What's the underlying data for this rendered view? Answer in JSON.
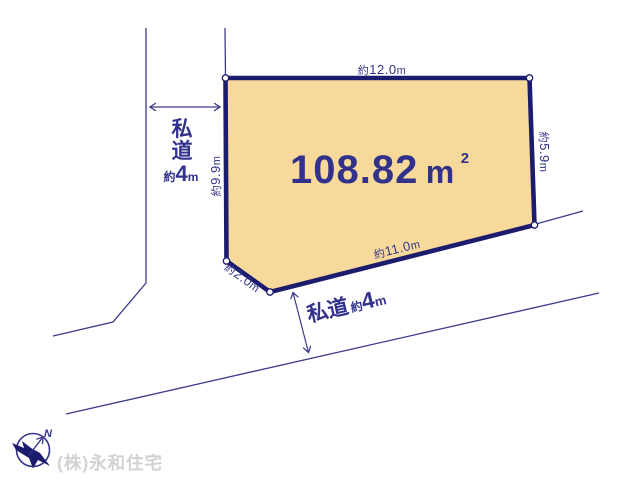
{
  "colors": {
    "plot_fill": "#f8d99c",
    "plot_border": "#1c1c6e",
    "text_navy": "#32328c",
    "line_navy": "#3b3b8c",
    "company_gray": "#d2d2d2"
  },
  "plot": {
    "area": {
      "value": "108.82",
      "unit": "m",
      "power": "2"
    },
    "dimensions": {
      "top": {
        "prefix": "約",
        "value": "12.0",
        "unit": "m"
      },
      "right": {
        "prefix": "約",
        "value": "5.9",
        "unit": "m"
      },
      "bottom": {
        "prefix": "約",
        "value": "11.0",
        "unit": "m"
      },
      "left": {
        "prefix": "約",
        "value": "9.9",
        "unit": "m"
      },
      "corner": {
        "prefix": "約",
        "value": "2.0",
        "unit": "m"
      }
    }
  },
  "roads": {
    "left": {
      "name_line1": "私",
      "name_line2": "道",
      "width_prefix": "約",
      "width_value": "4",
      "width_unit": "m"
    },
    "bottom": {
      "name": "私道",
      "width_prefix": "約",
      "width_value": "4",
      "width_unit": "m"
    }
  },
  "compass": {
    "north_label": "N"
  },
  "footer": {
    "company": "(株)永和住宅"
  }
}
